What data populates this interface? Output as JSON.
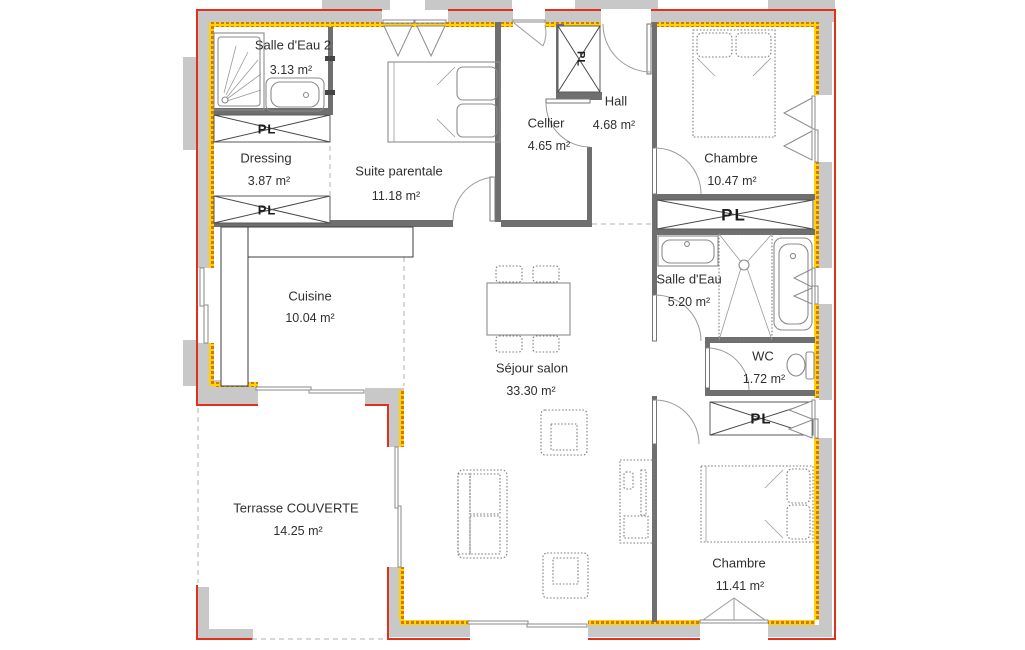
{
  "plan": {
    "rooms": [
      {
        "id": "salle-deau-2",
        "name": "Salle d'Eau 2",
        "area": "3.13 m²"
      },
      {
        "id": "dressing",
        "name": "Dressing",
        "area": "3.87 m²"
      },
      {
        "id": "suite-parentale",
        "name": "Suite parentale",
        "area": "11.18 m²"
      },
      {
        "id": "cellier",
        "name": "Cellier",
        "area": "4.65 m²"
      },
      {
        "id": "hall",
        "name": "Hall",
        "area": "4.68 m²"
      },
      {
        "id": "chambre-nord",
        "name": "Chambre",
        "area": "10.47 m²"
      },
      {
        "id": "salle-deau",
        "name": "Salle d'Eau",
        "area": "5.20 m²"
      },
      {
        "id": "wc",
        "name": "WC",
        "area": "1.72 m²"
      },
      {
        "id": "cuisine",
        "name": "Cuisine",
        "area": "10.04 m²"
      },
      {
        "id": "sejour-salon",
        "name": "Séjour salon",
        "area": "33.30 m²"
      },
      {
        "id": "terrasse",
        "name": "Terrasse COUVERTE",
        "area": "14.25 m²"
      },
      {
        "id": "chambre-sud",
        "name": "Chambre",
        "area": "11.41 m²"
      }
    ],
    "closet_label": "PL",
    "colors": {
      "outline_red": "#e0301e",
      "wall_gray": "#c8c8c8",
      "insulation_yellow": "#ffd200",
      "insulation_dash": "#d07818",
      "interior_wall": "#6f6f6f"
    }
  }
}
